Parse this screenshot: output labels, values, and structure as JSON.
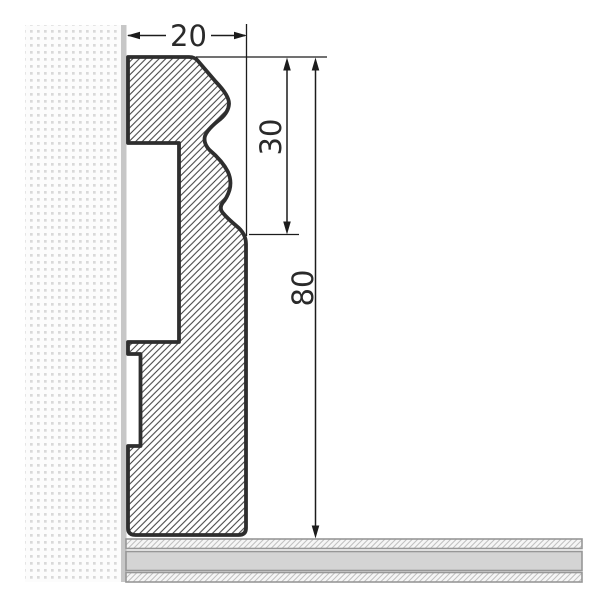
{
  "drawing": {
    "type": "technical-cross-section",
    "subject": "skirting-board profile mounted on wall above floor",
    "dimensions": {
      "width": {
        "label": "20"
      },
      "upper_height": {
        "label": "30"
      },
      "total_height": {
        "label": "80"
      }
    },
    "colors": {
      "outline": "#2e2e2e",
      "hatch": "#3d3d3d",
      "dimension_line": "#1c1c1c",
      "text": "#2a2a2a",
      "wall_dot": "#d9d9d9",
      "wall_surface": "#c7c7c7",
      "floor_core": "#d4d4d4",
      "floor_edge": "#979797",
      "background": "#ffffff"
    }
  }
}
